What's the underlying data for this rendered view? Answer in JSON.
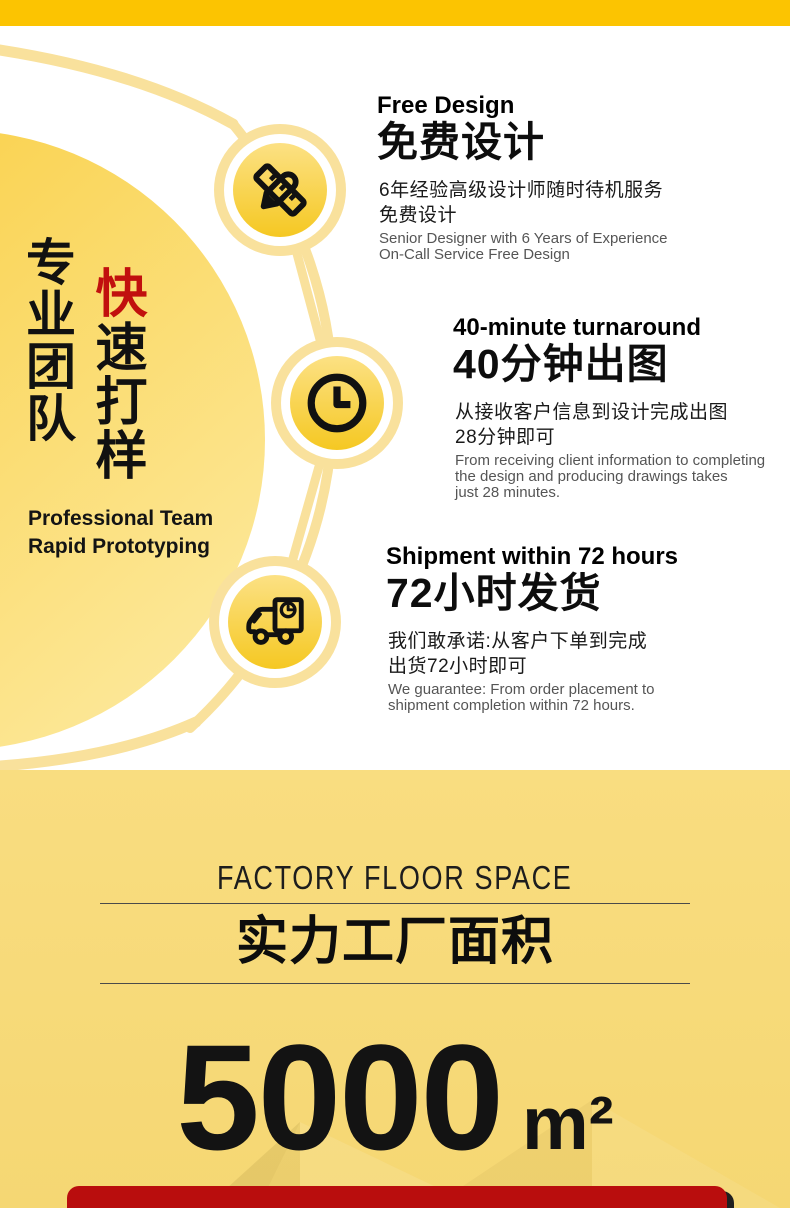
{
  "colors": {
    "top_bar_yellow": "#fcc401",
    "hero_circle_gradient_start": "#f8cb37",
    "hero_circle_gradient_end": "#fdeaa0",
    "ring_yellow": "#f9e19c",
    "badge_gradient_start": "#fce184",
    "badge_gradient_end": "#f5c822",
    "accent_red_text": "#c1100e",
    "factory_bg_yellow": "#f8db7b",
    "bottom_bar_red": "#b90d0d"
  },
  "hero": {
    "vertical_title_black": "专业团队",
    "vertical_title_accent_char": "快",
    "vertical_title_rest": "速打样",
    "subtitle_en": "Professional Team\nRapid Prototyping",
    "features": [
      {
        "icon": "pencil-ruler-icon",
        "title_en": "Free Design",
        "title_cn": "免费设计",
        "desc_cn": "6年经验高级设计师随时待机服务\n免费设计",
        "desc_en": "Senior Designer with 6 Years of Experience\nOn-Call Service Free Design"
      },
      {
        "icon": "clock-icon",
        "title_en": "40-minute turnaround",
        "title_cn": "40分钟出图",
        "desc_cn": "从接收客户信息到设计完成出图\n28分钟即可",
        "desc_en": "From receiving client information to completing\nthe design and producing drawings takes\njust 28 minutes."
      },
      {
        "icon": "truck-icon",
        "title_en": "Shipment within 72 hours",
        "title_cn": "72小时发货",
        "desc_cn": "我们敢承诺:从客户下单到完成\n出货72小时即可",
        "desc_en": "We guarantee: From order placement to\nshipment completion within 72 hours."
      }
    ]
  },
  "factory": {
    "heading_en": "FACTORY FLOOR SPACE",
    "heading_cn": "实力工厂面积",
    "area_value": "5000",
    "area_unit": "m²"
  }
}
